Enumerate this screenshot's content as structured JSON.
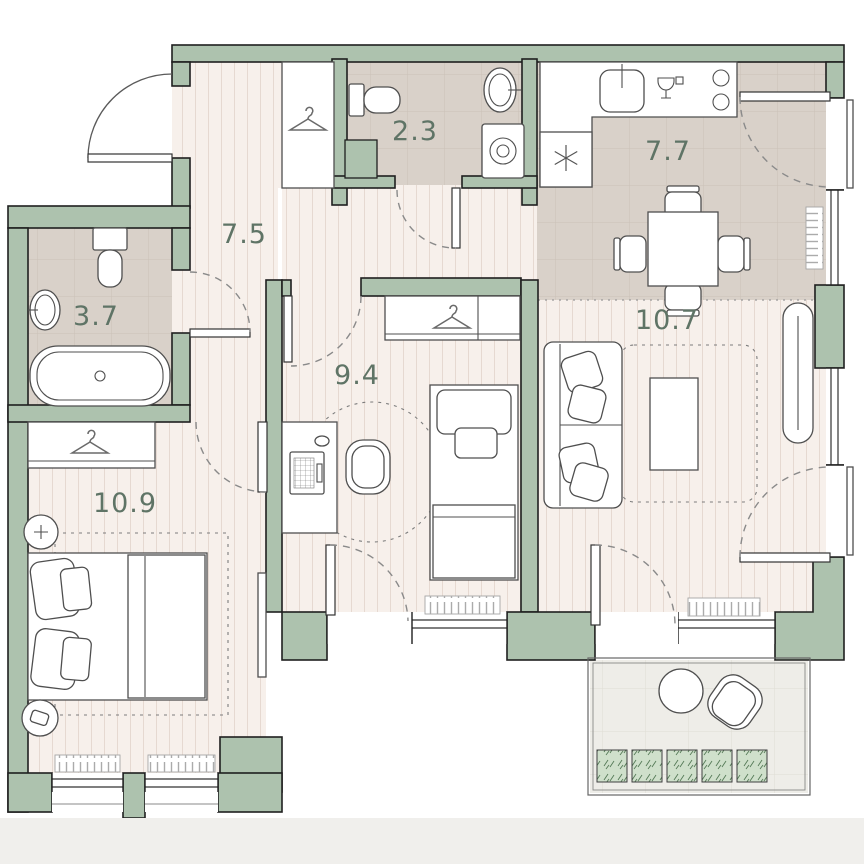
{
  "plan": {
    "rooms": {
      "hallway": {
        "area": "7.5"
      },
      "wc": {
        "area": "2.3"
      },
      "kitchen": {
        "area": "7.7"
      },
      "bathroom": {
        "area": "3.7"
      },
      "bedroom": {
        "area": "10.9"
      },
      "kids_room": {
        "area": "9.4"
      },
      "living_room": {
        "area": "10.7"
      }
    },
    "colors": {
      "wall": "#adc2ae",
      "outline": "#1f1f1f",
      "plank_floor": "#f7f0eb",
      "tile_floor": "#d9d1c9",
      "balcony_floor": "#eeede8",
      "label": "#5f7466",
      "plant": "#cfe0cb"
    }
  }
}
